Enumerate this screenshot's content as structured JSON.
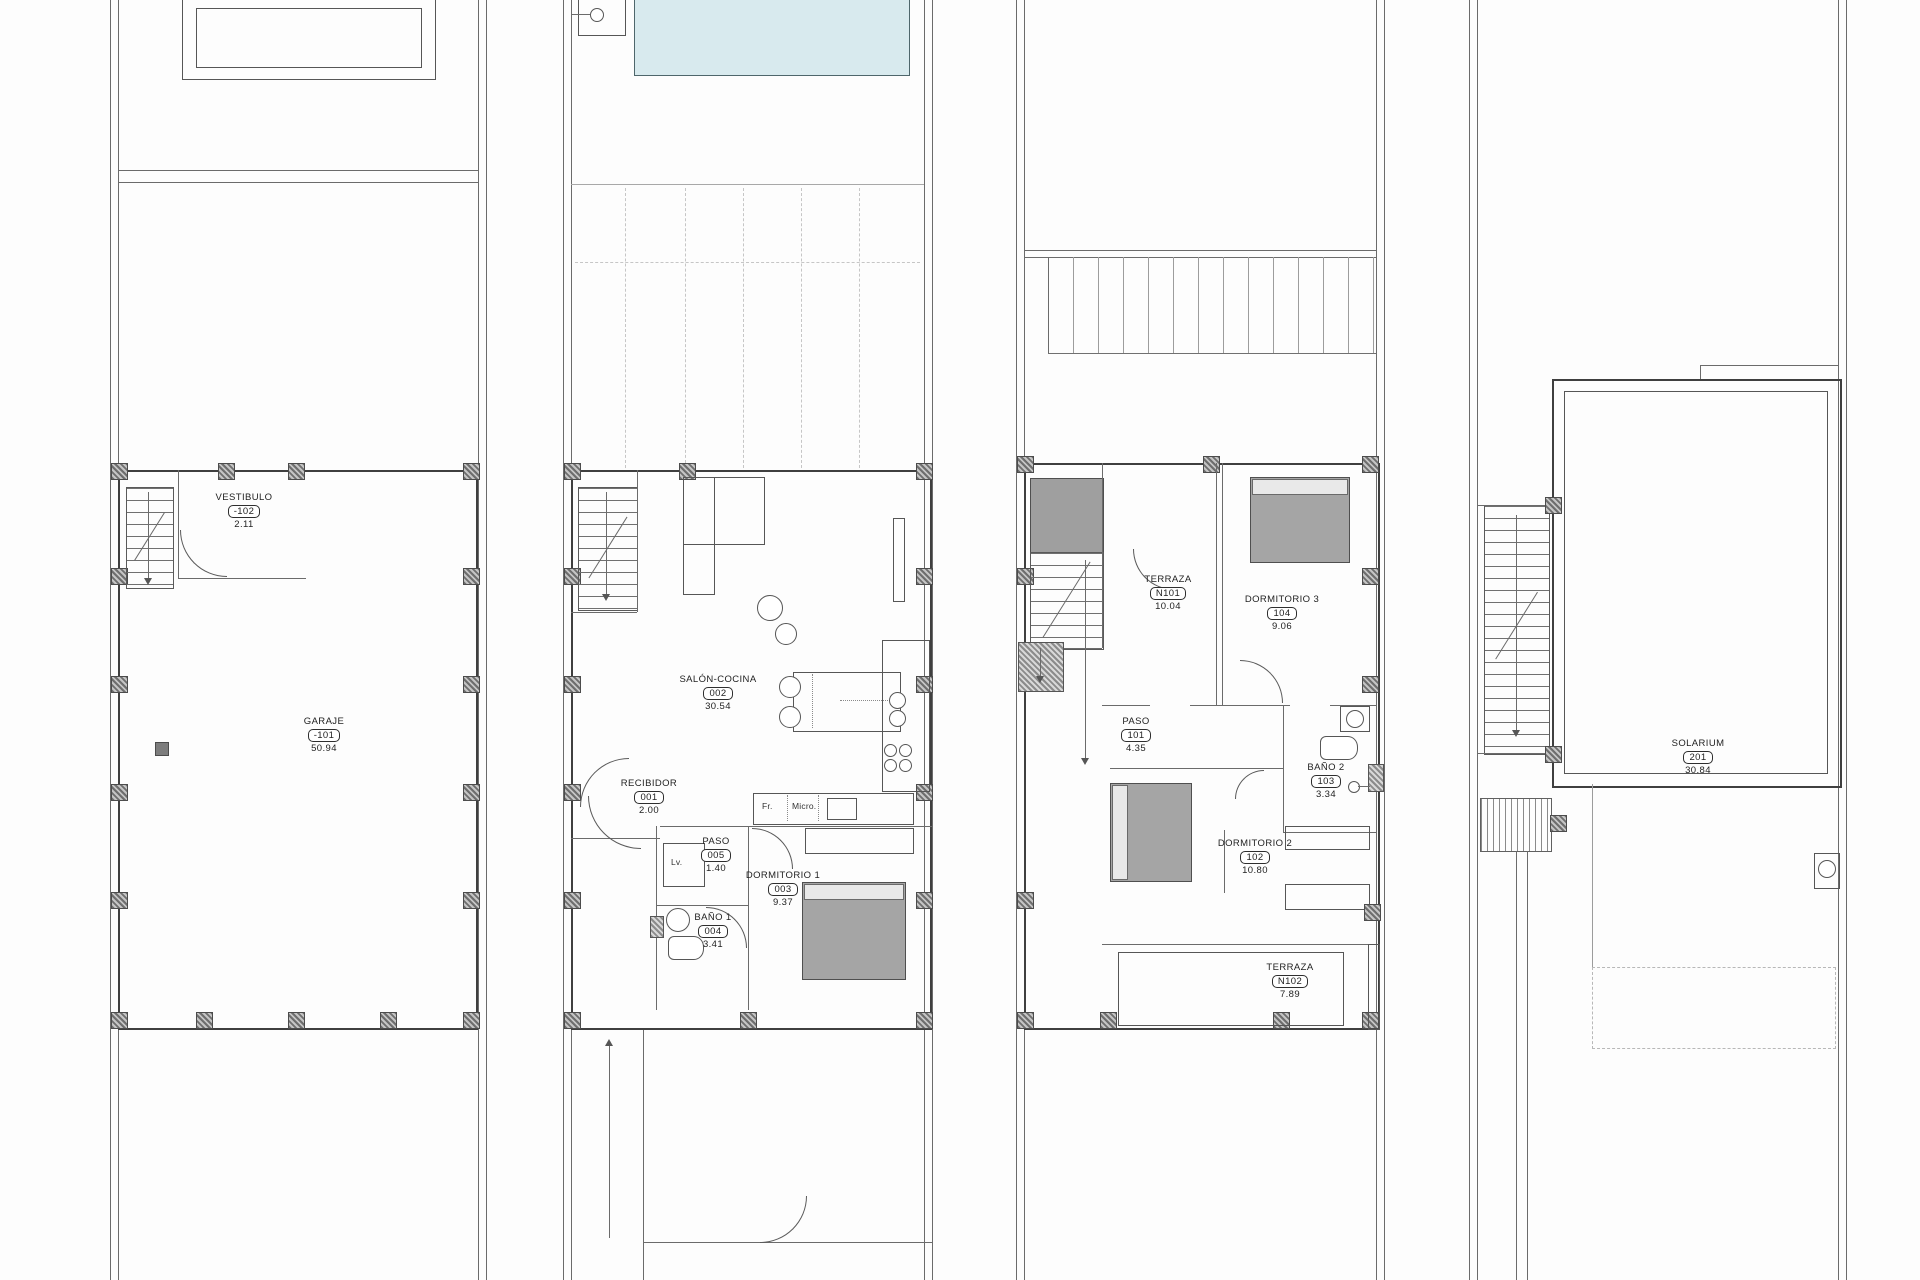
{
  "colors": {
    "pool_fill": "#d8eaee",
    "line": "#565656",
    "pillar_hatch": "#6e6e6e",
    "bed_fill": "#a5a5a5"
  },
  "plans": [
    {
      "id": "basement",
      "rooms": [
        {
          "name": "VESTIBULO",
          "code": "-102",
          "area": "2.11"
        },
        {
          "name": "GARAJE",
          "code": "-101",
          "area": "50.94"
        }
      ]
    },
    {
      "id": "ground-floor",
      "rooms": [
        {
          "name": "SALÓN-COCINA",
          "code": "002",
          "area": "30.54"
        },
        {
          "name": "RECIBIDOR",
          "code": "001",
          "area": "2.00"
        },
        {
          "name": "PASO",
          "code": "005",
          "area": "1.40"
        },
        {
          "name": "BAÑO 1",
          "code": "004",
          "area": "3.41"
        },
        {
          "name": "DORMITORIO 1",
          "code": "003",
          "area": "9.37"
        }
      ],
      "labels": {
        "fridge": "Fr.",
        "microwave": "Micro.",
        "washer": "Lv."
      }
    },
    {
      "id": "first-floor",
      "rooms": [
        {
          "name": "TERRAZA",
          "code": "N101",
          "area": "10.04"
        },
        {
          "name": "DORMITORIO 3",
          "code": "104",
          "area": "9.06"
        },
        {
          "name": "PASO",
          "code": "101",
          "area": "4.35"
        },
        {
          "name": "BAÑO 2",
          "code": "103",
          "area": "3.34"
        },
        {
          "name": "DORMITORIO 2",
          "code": "102",
          "area": "10.80"
        },
        {
          "name": "TERRAZA",
          "code": "N102",
          "area": "7.89"
        }
      ]
    },
    {
      "id": "roof",
      "rooms": [
        {
          "name": "SOLARIUM",
          "code": "201",
          "area": "30.84"
        }
      ]
    }
  ]
}
